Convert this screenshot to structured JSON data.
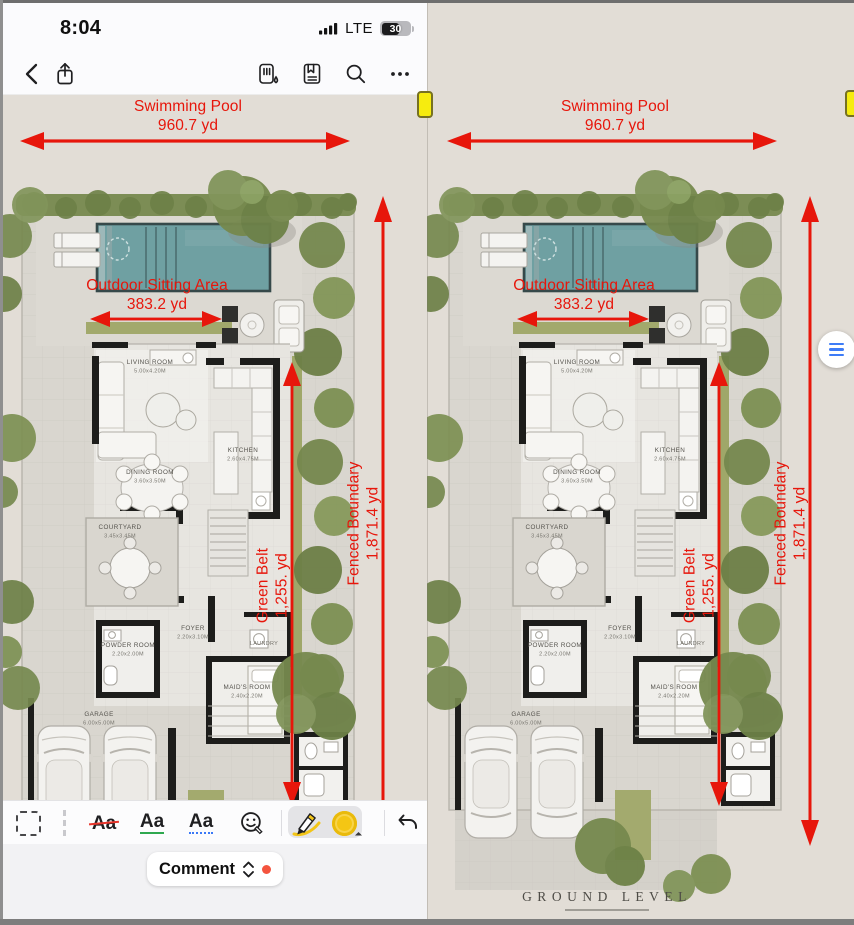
{
  "status_bar": {
    "time": "8:04",
    "network": "LTE",
    "battery_percent": "30",
    "signal_bars": 4
  },
  "nav_bar": {
    "icons": [
      "back-chevron",
      "share",
      "markup-document",
      "annotation-list",
      "search",
      "more-ellipsis"
    ]
  },
  "annotations": {
    "color": "#e7160b",
    "swimming_pool": {
      "label": "Swimming Pool",
      "value": "960.7 yd"
    },
    "outdoor_sitting": {
      "label": "Outdoor Sitting Area",
      "value": "383.2 yd"
    },
    "green_belt": {
      "label": "Green Belt",
      "value": "1,255. yd"
    },
    "fenced_boundary": {
      "label": "Fenced Boundary",
      "value": "1,871.4 yd"
    }
  },
  "floor_plan": {
    "level_label": "GROUND LEVEL",
    "rooms": {
      "living": {
        "name": "LIVING ROOM",
        "dims": "5.00x4.20M"
      },
      "kitchen": {
        "name": "KITCHEN",
        "dims": "2.60x4.75M"
      },
      "dining": {
        "name": "DINING ROOM",
        "dims": "3.60x3.50M"
      },
      "courtyard": {
        "name": "COURTYARD",
        "dims": "3.45x3.45M"
      },
      "foyer": {
        "name": "FOYER",
        "dims": "2.20x3.10M"
      },
      "powder": {
        "name": "POWDER ROOM",
        "dims": "2.20x2.00M"
      },
      "laundry": {
        "name": "LAUNDRY",
        "dims": ""
      },
      "maids": {
        "name": "MAID'S ROOM",
        "dims": "2.40x2.20M"
      },
      "garage": {
        "name": "GARAGE",
        "dims": "6.00x5.00M"
      }
    }
  },
  "markup_toolbar": {
    "text_strike": "Aa",
    "text_underline": "Aa",
    "text_dotted": "Aa",
    "selected_color": "#f4c614"
  },
  "comment_bar": {
    "label": "Comment"
  }
}
